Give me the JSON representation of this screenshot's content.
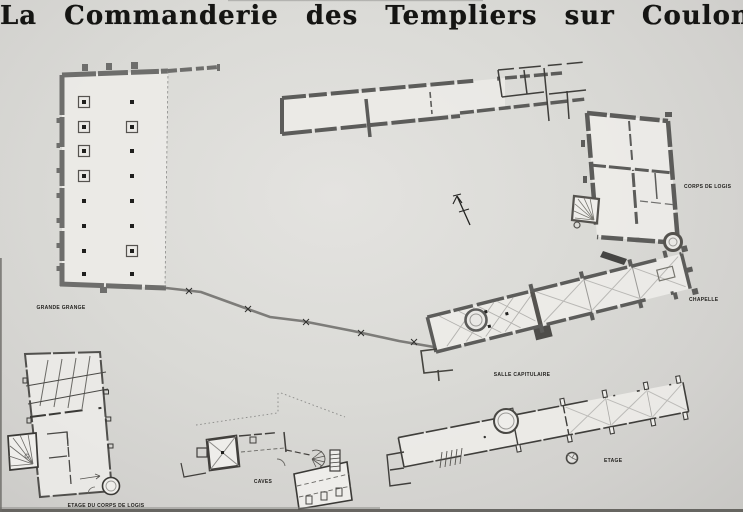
{
  "title": "La Commanderie des Templiers sur Coulommiers",
  "buildings": [
    {
      "id": "grande-grange",
      "label": "GRANDE GRANGE"
    },
    {
      "id": "corps-de-logis",
      "label": "CORPS DE LOGIS"
    },
    {
      "id": "chapelle",
      "label": "CHAPELLE"
    },
    {
      "id": "salle-capitulaire",
      "label": "SALLE CAPITULAIRE"
    },
    {
      "id": "etage-du-corps-de-logis",
      "label": "ETAGE DU CORPS DE LOGIS"
    },
    {
      "id": "caves",
      "label": "CAVES"
    },
    {
      "id": "etage",
      "label": "ETAGE"
    }
  ],
  "icons": {
    "north_arrow": "north-arrow"
  },
  "colors": {
    "paper": "#dadad6",
    "ink": "#23221f",
    "heavy_wall": "#5c5c5a",
    "thin_wall": "#3f3e3b",
    "light_line": "#b3b2af",
    "interior": "#edece9"
  }
}
